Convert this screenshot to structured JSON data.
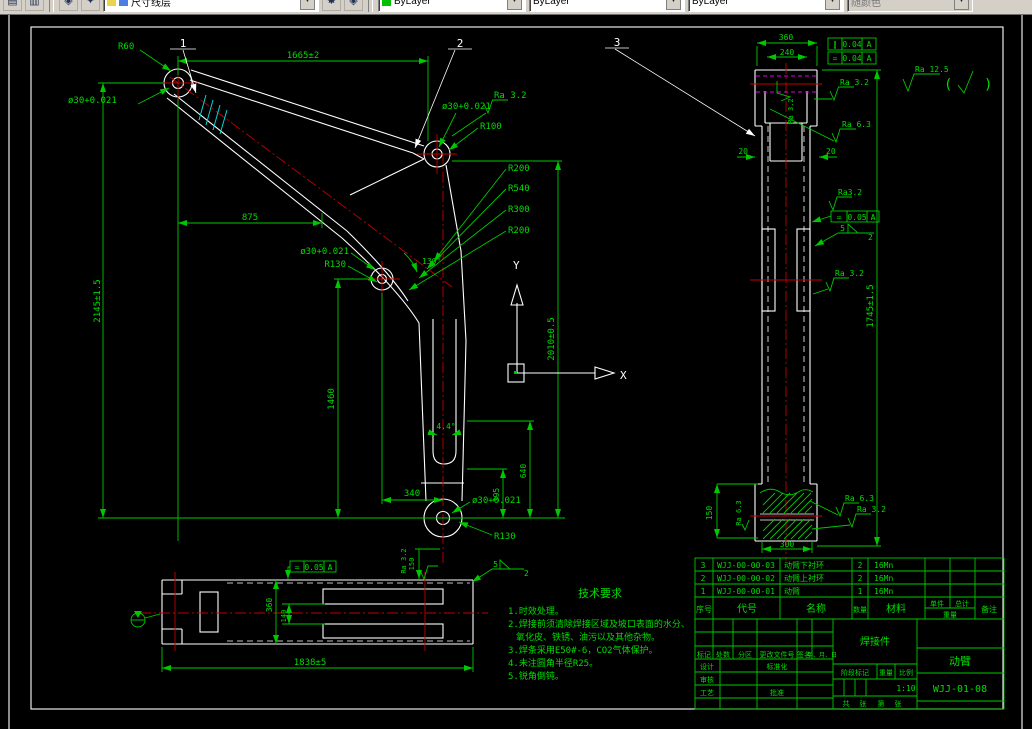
{
  "toolbar": {
    "layer_name": "尺寸线层",
    "color": "ByLayer",
    "linetype": "ByLayer",
    "lineweight": "ByLayer",
    "plot_style": "随颜色"
  },
  "balloons": {
    "b1": "1",
    "b2": "2",
    "b3": "3"
  },
  "ucs": {
    "x_label": "X",
    "y_label": "Y"
  },
  "general_roughness": {
    "ra": "Ra 12.5",
    "open": "(",
    "close": ")"
  },
  "main_view": {
    "top_width": "1665±2",
    "mid_width": "875",
    "left_height": "2145±1.5",
    "right_height": "2010±0.5",
    "leg_height": "1460",
    "dim_a": "395",
    "dim_b": "640",
    "bottom_width": "340",
    "angle_elbow": "130°",
    "angle_leg": "4.4°",
    "hub1_hole": "ø30+0.021",
    "hub1_radius": "R60",
    "hub2_hole": "ø30+0.021",
    "hub2_ra": "Ra 3.2",
    "hub2_radius": "R100",
    "r1": "R200",
    "r2": "R540",
    "r3": "R300",
    "r4": "R200",
    "mid_hole": "ø30+0.021",
    "mid_radius": "R130",
    "bottom_hole": "ø30+0.021",
    "bottom_radius": "R130"
  },
  "right_view": {
    "width_top": "360",
    "width_inner": "240",
    "fcf1": {
      "sym": "∥",
      "val": "0.04",
      "datum": "A"
    },
    "fcf2": {
      "sym": "=",
      "val": "0.04",
      "datum": "A"
    },
    "fcf3": {
      "sym": "=",
      "val": "0.05",
      "datum": "A"
    },
    "ra_cap": "Ra 3.2",
    "ra_a": "Ra 3.2",
    "ra_b": "Ra 6.3",
    "side_left": "20",
    "side_right": "20",
    "ra_mid": "Ra3.2",
    "weld_size": "5",
    "weld_count": "2",
    "ra_c": "Ra 3.2",
    "height": "1745±1.5",
    "bottom_height": "150",
    "bottom_width": "300",
    "ra_d": "Ra 6.3",
    "ra_e": "Ra 6.3",
    "ra_f": "Ra 3.2"
  },
  "section_view": {
    "fcf": {
      "sym": "=",
      "val": "0.05",
      "datum": "A"
    },
    "height": "360",
    "inner": "140",
    "length": "1838±5",
    "end": "150",
    "ra": "Ra 3.2",
    "weld_size": "5",
    "weld_count": "2"
  },
  "tech_req": {
    "title": "技术要求",
    "lines": [
      "1.时效处理。",
      "2.焊接前须清除焊接区域及坡口表面的水分、",
      "氧化皮、铁锈、油污以及其他杂物。",
      "3.焊条采用E50#-6，CO2气体保护。",
      "4.未注圆角半径R25。",
      "5.锐角倒钝。"
    ]
  },
  "bom": {
    "headers": {
      "seq": "序号",
      "code": "代号",
      "name": "名称",
      "qty": "数量",
      "material": "材料",
      "unit": "单件",
      "total": "总计",
      "weight": "重量",
      "remark": "备注"
    },
    "rows": [
      {
        "seq": "3",
        "code": "WJJ-00-00-03",
        "name": "动臂下衬环",
        "qty": "2",
        "material": "16Mn"
      },
      {
        "seq": "2",
        "code": "WJJ-00-00-02",
        "name": "动臂上衬环",
        "qty": "2",
        "material": "16Mn"
      },
      {
        "seq": "1",
        "code": "WJJ-00-00-01",
        "name": "动臂",
        "qty": "1",
        "material": "16Mn"
      }
    ]
  },
  "title_block": {
    "type": "焊接件",
    "part": "动臂",
    "number": "WJJ-01-08",
    "c1": "标记",
    "c2": "处数",
    "c3": "分区",
    "c4": "更改文件号",
    "c5": "签名",
    "c6": "年、月、日",
    "design": "设计",
    "standard": "标准化",
    "check": "审核",
    "process": "工艺",
    "approve": "批准",
    "stage": "阶段标记",
    "weight": "重量",
    "scale": "比例",
    "scale_value": "1:10",
    "s1": "共",
    "s2": "张",
    "s3": "第",
    "s4": "张"
  },
  "colors": {
    "line_green": "#00c800",
    "line_white": "#ffffff",
    "centerline_red": "#c00000",
    "weld_cyan": "#00d8d8",
    "magenta": "#dd00dd",
    "bg": "#000000"
  }
}
